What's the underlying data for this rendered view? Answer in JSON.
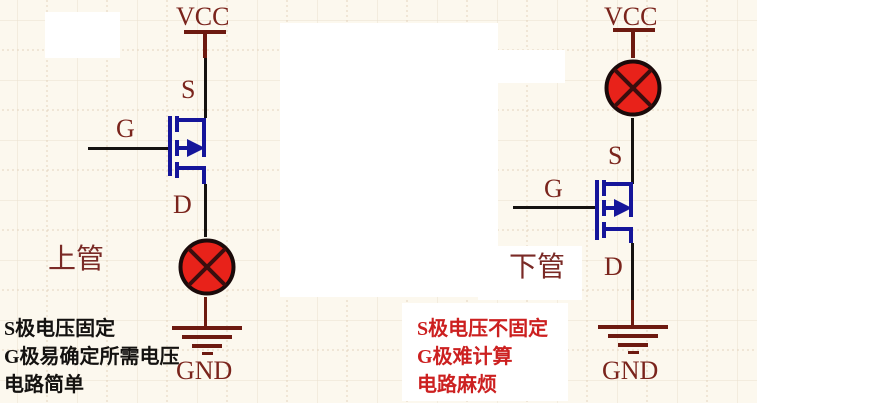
{
  "title": "MOSFET high-side vs low-side lamp driver comparison schematic",
  "colors": {
    "background_paper": "#fcf8ee",
    "power_symbol_maroon": "#6d1a10",
    "pin_label_maroon": "#7a241c",
    "mosfet_blue": "#15159a",
    "wire_black": "#151210",
    "lamp_red": "#e8221a",
    "note_red": "#cc2020",
    "note_black": "#141210"
  },
  "left_circuit": {
    "name_label": "上管",
    "vcc_label": "VCC",
    "gnd_label": "GND",
    "s_label": "S",
    "g_label": "G",
    "d_label": "D",
    "notes": [
      "S极电压固定",
      "G极易确定所需电压",
      "电路简单"
    ]
  },
  "right_circuit": {
    "name_label": "下管",
    "vcc_label": "VCC",
    "gnd_label": "GND",
    "s_label": "S",
    "g_label": "G",
    "d_label": "D",
    "notes": [
      "S极电压不固定",
      "G极难计算",
      "电路麻烦"
    ]
  }
}
